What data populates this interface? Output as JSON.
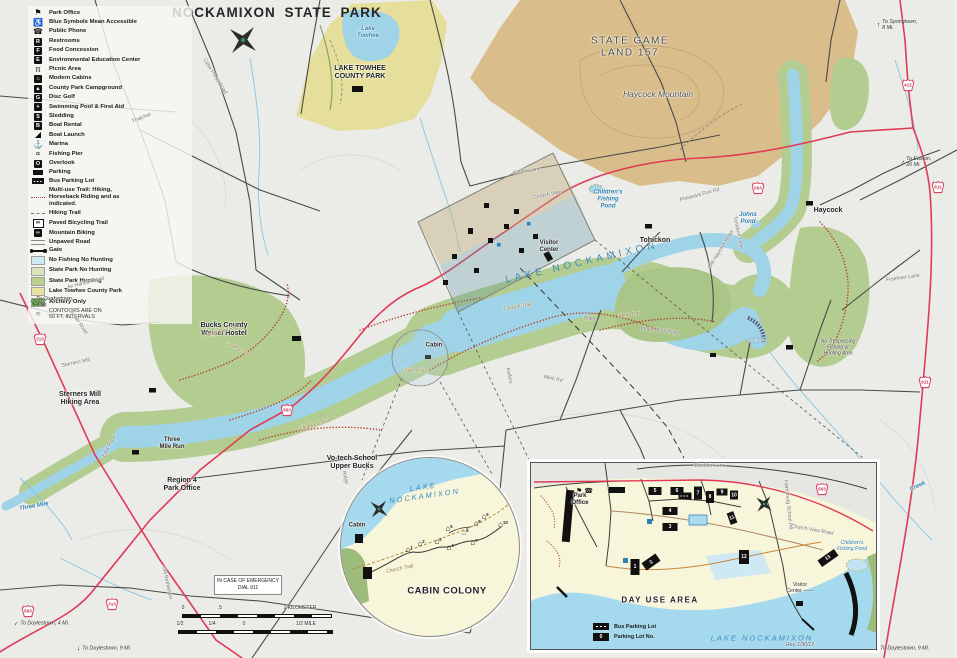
{
  "title": "NOCKAMIXON STATE PARK",
  "colors": {
    "lake": "#9fd3e8",
    "park_green": "#b3cc90",
    "game_land_tan": "#d9be8c",
    "towhee_yellow": "#e6df9b",
    "red_road": "#e03a56",
    "accessible_blue": "#1a6fb5"
  },
  "legend": {
    "items": [
      {
        "name": "park-office",
        "label": "Park Office",
        "icon": "flag"
      },
      {
        "name": "accessible",
        "label": "Blue Symbols Mean Accessible",
        "icon": "wheelchair"
      },
      {
        "name": "public-phone",
        "label": "Public Phone",
        "icon": "phone"
      },
      {
        "name": "restrooms",
        "label": "Restrooms",
        "icon": "restrooms"
      },
      {
        "name": "food-concession",
        "label": "Food Concession",
        "icon": "food"
      },
      {
        "name": "env-ed-center",
        "label": "Environmental Education Center",
        "icon": "education"
      },
      {
        "name": "picnic-area",
        "label": "Picnic Area",
        "icon": "picnic"
      },
      {
        "name": "modern-cabins",
        "label": "Modern Cabins",
        "icon": "cabin"
      },
      {
        "name": "county-park-campground",
        "label": "County Park Campground",
        "icon": "campground"
      },
      {
        "name": "disc-golf",
        "label": "Disc Golf",
        "icon": "disc-golf"
      },
      {
        "name": "swimming-pool",
        "label": "Swimming Pool & First Aid",
        "icon": "pool"
      },
      {
        "name": "sledding",
        "label": "Sledding",
        "icon": "sledding"
      },
      {
        "name": "boat-rental",
        "label": "Boat Rental",
        "icon": "boat-rental"
      },
      {
        "name": "boat-launch",
        "label": "Boat Launch",
        "icon": "boat-launch"
      },
      {
        "name": "marina",
        "label": "Marina",
        "icon": "marina"
      },
      {
        "name": "fishing-pier",
        "label": "Fishing Pier",
        "icon": "fishing-pier"
      },
      {
        "name": "overlook",
        "label": "Overlook",
        "icon": "overlook"
      },
      {
        "name": "parking",
        "label": "Parking",
        "icon": "parking"
      },
      {
        "name": "bus-parking-lot",
        "label": "Bus Parking Lot",
        "icon": "bus-parking"
      },
      {
        "name": "multi-use-trail",
        "label": "Multi-use Trail: Hiking,\nHorseback Riding and as\nindicated.",
        "icon": "multiuse-trail"
      },
      {
        "name": "hiking-trail",
        "label": "Hiking Trail",
        "icon": "hiking-trail"
      },
      {
        "name": "paved-bicycling-trail",
        "label": "Paved Bicycling Trail",
        "icon": "paved-bicycling"
      },
      {
        "name": "mountain-biking",
        "label": "Mountain Biking",
        "icon": "mountain-biking"
      },
      {
        "name": "unpaved-road",
        "label": "Unpaved Road",
        "icon": "unpaved-road"
      },
      {
        "name": "gate",
        "label": "Gate",
        "icon": "gate"
      },
      {
        "name": "zone-no-fishing-no-hunting",
        "label": "No Fishing No Hunting",
        "icon": "zone",
        "color": "#cfe9f4"
      },
      {
        "name": "zone-state-park-no-hunting",
        "label": "State Park No Hunting",
        "icon": "zone",
        "color": "#d9e4bc"
      },
      {
        "name": "zone-state-park-hunting",
        "label": "State Park Hunting",
        "icon": "zone",
        "color": "#b9cf90"
      },
      {
        "name": "zone-lake-towhee-county-park",
        "label": "Lake Towhee County Park",
        "icon": "zone",
        "color": "#e9e2a0"
      },
      {
        "name": "zone-archery-only",
        "label": "Archery Only",
        "icon": "zone-archery",
        "color": "#6f9e4f"
      }
    ],
    "note1": "CONTOURS ARE ON",
    "note2": "50 FT. INTERVALS"
  },
  "emergency": {
    "line1": "IN CASE OF EMERGENCY",
    "line2": "DIAL 911"
  },
  "map_labels": [
    {
      "n": "lake-towhee-label",
      "t": "Lake\nTowhee",
      "c": "t-blue",
      "x": 368,
      "y": 33
    },
    {
      "n": "lake-towhee-county-park-label",
      "t": "LAKE TOWHEE\nCOUNTY PARK",
      "c": "t-b7",
      "x": 360,
      "y": 73
    },
    {
      "n": "state-game-land-label",
      "t": "STATE   GAME\nLAND    157",
      "c": "t-gl",
      "x": 630,
      "y": 47
    },
    {
      "n": "haycock-mountain-label",
      "t": "Haycock Mountain",
      "c": "t-hm",
      "x": 658,
      "y": 95
    },
    {
      "n": "lake-nockamixon-label",
      "t": "LAKE   NOCKAMIXON",
      "c": "t-lake",
      "x": 582,
      "y": 263,
      "r": -13
    },
    {
      "n": "weisel-hostel-label",
      "t": "Bucks County\nWeisel Hostel",
      "c": "t-b7",
      "x": 224,
      "y": 330
    },
    {
      "n": "sterners-mill-hiking-label",
      "t": "Sterners Mill\nHiking Area",
      "c": "t-b7",
      "x": 80,
      "y": 399
    },
    {
      "n": "three-mile-run-label",
      "t": "Three\nMile Run",
      "c": "t-b6",
      "x": 172,
      "y": 444
    },
    {
      "n": "region4-park-office-label",
      "t": "Region 4\nPark Office",
      "c": "t-b7",
      "x": 182,
      "y": 485
    },
    {
      "n": "votech-school-label",
      "t": "Vo-tech School\nUpper Bucks",
      "c": "t-b7",
      "x": 352,
      "y": 463
    },
    {
      "n": "tohickon-launch-label",
      "t": "Tohickon",
      "c": "t-b7",
      "x": 655,
      "y": 241
    },
    {
      "n": "haycock-launch-label",
      "t": "Haycock",
      "c": "t-b7",
      "x": 828,
      "y": 211
    },
    {
      "n": "childrens-pond-label",
      "t": "Children's\nFishing\nPond",
      "c": "t-blue",
      "x": 608,
      "y": 200
    },
    {
      "n": "visitor-center-label",
      "t": "Visitor\nCenter",
      "c": "t-b6",
      "x": 549,
      "y": 247
    },
    {
      "n": "cabin-area-label",
      "t": "Cabin",
      "c": "t-b6",
      "x": 434,
      "y": 346
    },
    {
      "n": "spillway-label",
      "t": "Spillway",
      "c": "t-spill",
      "x": 757,
      "y": 341,
      "r": -5
    },
    {
      "n": "no-trespassing-label",
      "t": "No Trespassing\nFishing or\nHunting Area",
      "c": "t-notresp",
      "x": 838,
      "y": 348
    },
    {
      "n": "johns-pond-label",
      "t": "Johns\nPond",
      "c": "t-blue",
      "x": 748,
      "y": 219
    },
    {
      "n": "three-mile-creek-label",
      "t": "Three  Mile",
      "c": "t-blue",
      "x": 34,
      "y": 507,
      "r": -10
    },
    {
      "n": "creek-label",
      "t": "Creek",
      "c": "t-blue",
      "x": 918,
      "y": 487,
      "r": -25
    },
    {
      "n": "thatcher-road-label",
      "t": "Thatcher",
      "c": "t-road",
      "x": 142,
      "y": 119,
      "r": -22
    },
    {
      "n": "cider-press-road-label",
      "t": "Cider  Press  Road",
      "c": "t-road",
      "x": 214,
      "y": 77,
      "r": 58
    },
    {
      "n": "kinder-lane-label",
      "t": "Kinder   Lane",
      "c": "t-road",
      "x": 527,
      "y": 172,
      "r": -8
    },
    {
      "n": "church-view-label",
      "t": "Church   View",
      "c": "t-road",
      "x": 548,
      "y": 196,
      "r": -12
    },
    {
      "n": "old-haycock-road-label",
      "t": "Old  Haycock  Road",
      "c": "t-road",
      "x": 722,
      "y": 250,
      "r": -58
    },
    {
      "n": "tohickon-lane-label",
      "t": "Tohickon  Lane",
      "c": "t-road",
      "x": 737,
      "y": 233,
      "r": 78
    },
    {
      "n": "pheasant-run-rd-label",
      "t": "Pheasant  Run  Rd",
      "c": "t-road",
      "x": 700,
      "y": 196,
      "r": -15
    },
    {
      "n": "clymer-road-label",
      "t": "Clymer  Road",
      "c": "t-road",
      "x": 77,
      "y": 322,
      "r": 55
    },
    {
      "n": "ax-handle-road-label",
      "t": "Ax  Handle  Road",
      "c": "t-road",
      "x": 86,
      "y": 284,
      "r": -14
    },
    {
      "n": "sterners-mill-road-label",
      "t": "Sterners  Mill",
      "c": "t-road",
      "x": 76,
      "y": 364,
      "r": -12
    },
    {
      "n": "east-rock-road-label",
      "t": "East  Rock",
      "c": "t-road",
      "x": 110,
      "y": 447,
      "r": -62
    },
    {
      "n": "old-bethlehem-road-label",
      "t": "Old  Bethlehem",
      "c": "t-road",
      "x": 166,
      "y": 583,
      "r": 78
    },
    {
      "n": "ridge-road-label",
      "t": "Ridge",
      "c": "t-road",
      "x": 344,
      "y": 478,
      "r": 75
    },
    {
      "n": "mink-rd-label",
      "t": "Mink  Rd",
      "c": "t-road",
      "x": 553,
      "y": 380,
      "r": 12
    },
    {
      "n": "kellers-road-label",
      "t": "Kellers",
      "c": "t-road",
      "x": 508,
      "y": 376,
      "r": 78
    },
    {
      "n": "froehner-lane-label",
      "t": "Froehner  Lane",
      "c": "t-road",
      "x": 903,
      "y": 279,
      "r": -8
    },
    {
      "n": "indian-trail-road-label",
      "t": "Indian  Trail  Road",
      "c": "t-road",
      "x": 660,
      "y": 332,
      "r": 8
    },
    {
      "n": "smith-road-label",
      "t": "Smith",
      "c": "t-road",
      "x": 590,
      "y": 320,
      "r": 6
    },
    {
      "n": "mink-trail-label",
      "t": "Mink  Trail",
      "c": "t-trail",
      "x": 630,
      "y": 316,
      "r": -8
    },
    {
      "n": "church-trail-label",
      "t": "Church  Trail",
      "c": "t-trail",
      "x": 518,
      "y": 308,
      "r": -10
    },
    {
      "n": "church-tr-label",
      "t": "Church Tr.",
      "c": "t-trail",
      "x": 414,
      "y": 372,
      "r": 4
    },
    {
      "n": "quarry-trail-label",
      "t": "Quarry  Trail",
      "c": "t-trail",
      "x": 238,
      "y": 350,
      "r": 28
    },
    {
      "n": "camp-trail-label",
      "t": "Camp  Trail  Rd",
      "c": "t-trail",
      "x": 220,
      "y": 333,
      "r": -14
    },
    {
      "n": "elephant-trail-label",
      "t": "Elephant  Trail",
      "c": "t-trail",
      "x": 315,
      "y": 426,
      "r": -16
    },
    {
      "n": "scale-km-0",
      "t": "0",
      "c": "t-scale",
      "x": 183,
      "y": 609
    },
    {
      "n": "scale-km-half",
      "t": ".5",
      "c": "t-scale",
      "x": 220,
      "y": 609
    },
    {
      "n": "scale-km-1",
      "t": "1 KILOMETER",
      "c": "t-scale",
      "x": 300,
      "y": 609
    },
    {
      "n": "scale-mi-half-left",
      "t": "1/2",
      "c": "t-scale",
      "x": 180,
      "y": 625
    },
    {
      "n": "scale-mi-quarter",
      "t": "1/4",
      "c": "t-scale",
      "x": 212,
      "y": 625
    },
    {
      "n": "scale-mi-0",
      "t": "0",
      "c": "t-scale",
      "x": 244,
      "y": 625
    },
    {
      "n": "scale-mi-half-right",
      "t": "1/2 MILE",
      "c": "t-scale",
      "x": 306,
      "y": 625
    },
    {
      "n": "dayuse-title-label",
      "t": "DAY  USE  AREA",
      "c": "t-dua",
      "x": 660,
      "y": 600
    },
    {
      "n": "dayuse-lake-label",
      "t": "LAKE      NOCKAMIXON",
      "c": "t-lake-c",
      "x": 762,
      "y": 639
    },
    {
      "n": "dayuse-park-office-label",
      "t": "Park\nOffice",
      "c": "t-b6",
      "x": 580,
      "y": 500
    },
    {
      "n": "dayuse-visitor-center-label",
      "t": "Visitor\nCenter ——",
      "c": "t-vc",
      "x": 800,
      "y": 589
    },
    {
      "n": "dayuse-pond-label",
      "t": "Children's\nFishing Pond",
      "c": "t-blue-s",
      "x": 852,
      "y": 547
    },
    {
      "n": "boulder-lane-label",
      "t": "Boulder                  Lane",
      "c": "t-road",
      "x": 710,
      "y": 467
    },
    {
      "n": "harrisburg-school-rd-label",
      "t": "Harrisburg School Rd",
      "c": "t-road",
      "x": 787,
      "y": 505,
      "r": 84
    },
    {
      "n": "church-view-road-inset-label",
      "t": "Church        View        Road",
      "c": "t-road",
      "x": 812,
      "y": 531,
      "r": 10
    },
    {
      "n": "rev-date-label",
      "t": "Rev. 1/30/12",
      "c": "t-rev",
      "x": 800,
      "y": 646
    },
    {
      "n": "cabin-colony-title",
      "t": "CABIN COLONY",
      "c": "t-cc",
      "x": 447,
      "y": 592
    },
    {
      "n": "cabin-lake-label",
      "t": "LAKE\nNOCKAMIXON",
      "c": "t-lake-c",
      "x": 424,
      "y": 492,
      "r": -8
    },
    {
      "n": "cabin-church-trail-label",
      "t": "Church  Trail",
      "c": "t-trail",
      "x": 400,
      "y": 570,
      "r": -12
    },
    {
      "n": "cabin-parking-label",
      "t": "Cabin",
      "c": "t-b6",
      "x": 357,
      "y": 526
    }
  ],
  "shields": [
    {
      "t": "313",
      "x": 40,
      "y": 339
    },
    {
      "t": "563",
      "x": 287,
      "y": 410
    },
    {
      "t": "563",
      "x": 758,
      "y": 188
    },
    {
      "t": "412",
      "x": 908,
      "y": 85
    },
    {
      "t": "611",
      "x": 938,
      "y": 187
    },
    {
      "t": "611",
      "x": 925,
      "y": 382
    },
    {
      "t": "563",
      "x": 28,
      "y": 611
    },
    {
      "t": "313",
      "x": 112,
      "y": 604
    },
    {
      "t": "563",
      "x": 822,
      "y": 489
    }
  ],
  "directions": [
    {
      "n": "dir-springtown",
      "t": "To Springtown,\n8 Mi.",
      "x": 897,
      "y": 25,
      "a": 0
    },
    {
      "n": "dir-easton",
      "t": "To Easton,\n20 Mi.",
      "x": 916,
      "y": 162,
      "a": 45
    },
    {
      "n": "dir-quakertown",
      "t": "To Quakertown,\n4 Mi.",
      "x": 52,
      "y": 302,
      "a": -45
    },
    {
      "n": "dir-doylestown-4mi",
      "t": "To Doylestown, 4 Mi.",
      "x": 42,
      "y": 623,
      "a": -135
    },
    {
      "n": "dir-doylestown-9mi-left",
      "t": "To Doylestown, 9 Mi.",
      "x": 104,
      "y": 648,
      "a": 180
    },
    {
      "n": "dir-doylestown-9mi-right",
      "t": "To Doylestown, 9 Mi.",
      "x": 902,
      "y": 648,
      "a": 180
    }
  ],
  "cabin_inset": {
    "cabins": [
      {
        "n": "1",
        "x": 408,
        "y": 549
      },
      {
        "n": "2",
        "x": 420,
        "y": 543
      },
      {
        "n": "3",
        "x": 437,
        "y": 541
      },
      {
        "n": "4",
        "x": 449,
        "y": 547
      },
      {
        "n": "5",
        "x": 448,
        "y": 528
      },
      {
        "n": "6",
        "x": 464,
        "y": 532,
        "accessible": true
      },
      {
        "n": "7",
        "x": 473,
        "y": 542
      },
      {
        "n": "8",
        "x": 476,
        "y": 523
      },
      {
        "n": "9",
        "x": 484,
        "y": 516
      },
      {
        "n": "10",
        "x": 502,
        "y": 524
      }
    ]
  },
  "dayuse_inset": {
    "lots": [
      {
        "n": "1",
        "x": 634,
        "y": 566,
        "w": 9,
        "h": 16,
        "r": 0
      },
      {
        "n": "2",
        "x": 650,
        "y": 561,
        "w": 17,
        "h": 9,
        "r": -35
      },
      {
        "n": "3",
        "x": 669,
        "y": 526,
        "w": 15,
        "h": 8,
        "r": 0
      },
      {
        "n": "4",
        "x": 669,
        "y": 510,
        "w": 15,
        "h": 8,
        "r": 0
      },
      {
        "n": "5",
        "x": 654,
        "y": 490,
        "w": 13,
        "h": 8,
        "r": 0
      },
      {
        "n": "6",
        "x": 676,
        "y": 490,
        "w": 13,
        "h": 8,
        "r": 0
      },
      {
        "n": "7",
        "x": 697,
        "y": 492,
        "w": 8,
        "h": 13,
        "r": 0
      },
      {
        "n": "8",
        "x": 709,
        "y": 496,
        "w": 8,
        "h": 12,
        "r": 0
      },
      {
        "n": "9",
        "x": 721,
        "y": 491,
        "w": 11,
        "h": 7,
        "r": 0
      },
      {
        "n": "10",
        "x": 733,
        "y": 494,
        "w": 8,
        "h": 9,
        "r": 0
      },
      {
        "n": "11",
        "x": 731,
        "y": 517,
        "w": 7,
        "h": 12,
        "r": -20
      },
      {
        "n": "12",
        "x": 743,
        "y": 556,
        "w": 10,
        "h": 14,
        "r": 0
      },
      {
        "n": "13",
        "x": 827,
        "y": 557,
        "w": 20,
        "h": 8,
        "r": -35
      },
      {
        "n": "",
        "x": 567,
        "y": 515,
        "w": 8,
        "h": 52,
        "r": 5
      },
      {
        "n": "",
        "x": 684,
        "y": 495,
        "w": 13,
        "h": 7,
        "r": 0,
        "bus": true
      }
    ],
    "legend": {
      "bus_label": "Bus Parking Lot",
      "lot_label": "Parking Lot No.",
      "lot_symbol": "0"
    }
  }
}
